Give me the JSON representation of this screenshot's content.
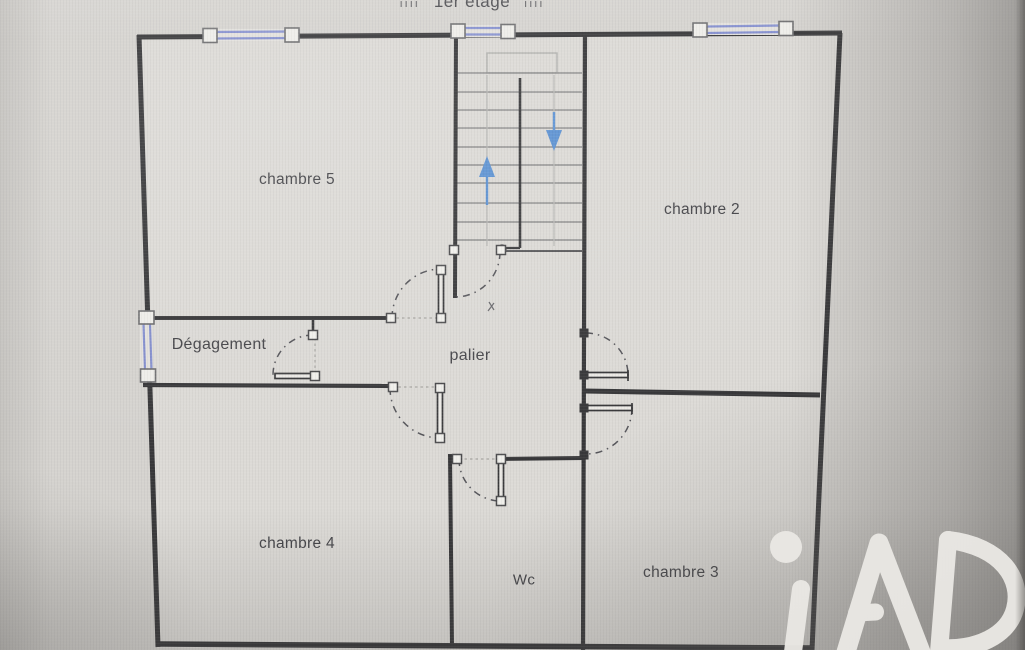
{
  "title": {
    "text": "1er étage",
    "ticks": "ıııı"
  },
  "rooms": {
    "chambre5": {
      "label": "chambre 5"
    },
    "chambre2": {
      "label": "chambre 2"
    },
    "degagement": {
      "label": "Dégagement"
    },
    "palier": {
      "label": "palier"
    },
    "chambre4": {
      "label": "chambre 4"
    },
    "wc": {
      "label": "Wc"
    },
    "chambre3": {
      "label": "chambre 3"
    }
  },
  "stairs": {
    "up_arrow_icon": "stair-up-arrow",
    "down_arrow_icon": "stair-down-arrow",
    "tread_count": 10
  },
  "symbols": {
    "window_icon": "window-symbol",
    "door_icon": "door-swing-symbol"
  },
  "watermark": {
    "text": "iAD"
  },
  "colors": {
    "wall": "#3a3a3c",
    "window_blue": "#8590cf",
    "stair_arrow_blue": "#5d92d2",
    "background": "#d5d3cf",
    "floor": "#dcdad6",
    "label_text": "#46464a",
    "watermark_text": "#eae8e4"
  }
}
